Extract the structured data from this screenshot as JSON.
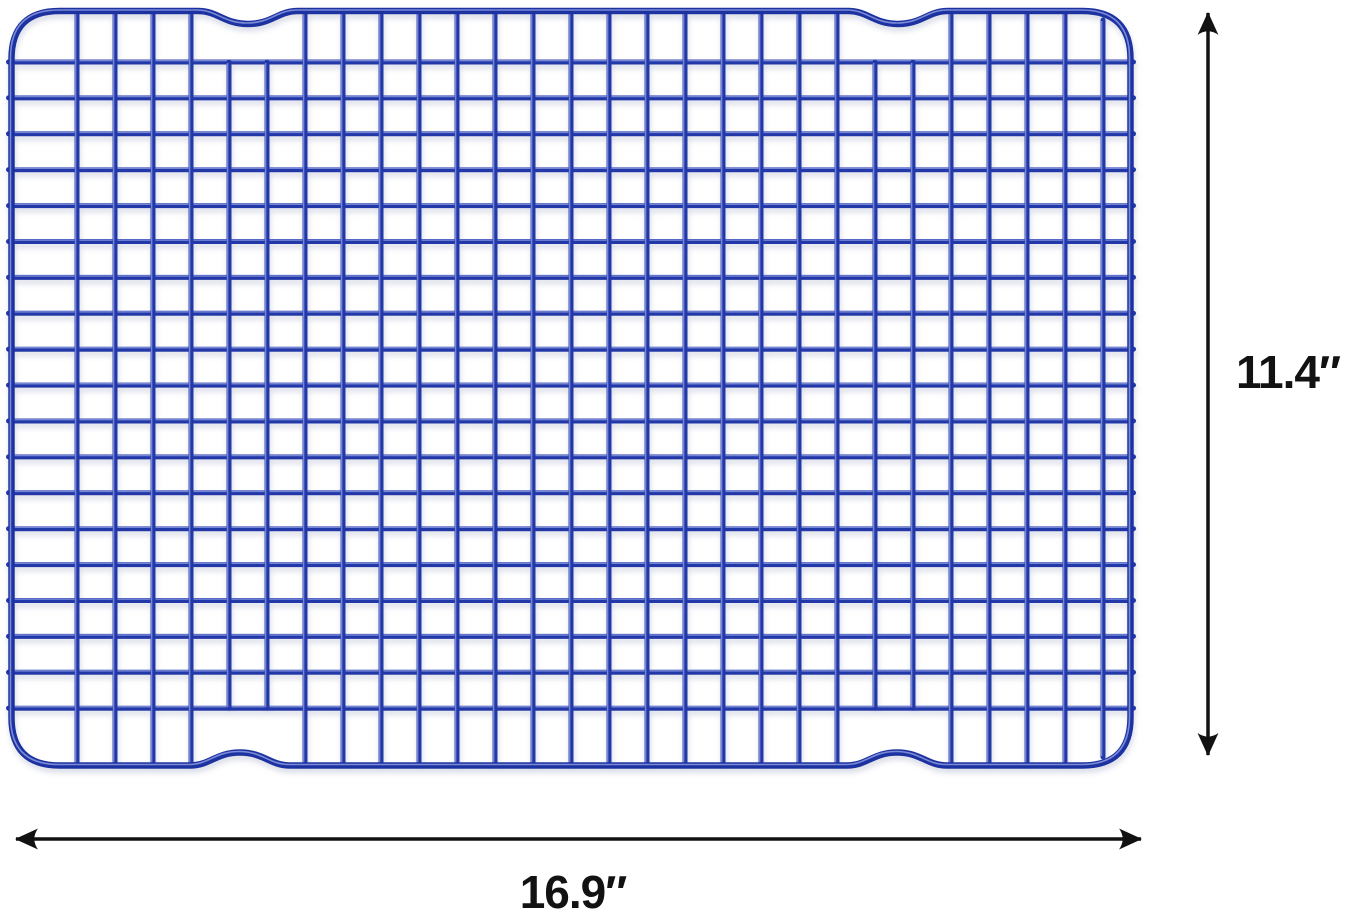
{
  "meta": {
    "type": "product-dimension-illustration",
    "subject": "Blue coated wire grid cooling rack (baking rack) viewed from above, annotated with measurement arrows",
    "background_color": "#ffffff"
  },
  "rack": {
    "label": "blue-wire-cooling-rack",
    "wire_color": "#2339a8",
    "wire_highlight_color": "#8494de",
    "frame_color": "#1f33a0",
    "shadow_color": "#9099b8",
    "cross_wires": 28,
    "long_wires": 19,
    "frame_style": "rounded rectangle with two shallow handle notches on top edge and two on bottom edge"
  },
  "dimensions": {
    "arrow_color": "#121212",
    "height": {
      "label": "11.4″",
      "side": "right"
    },
    "width": {
      "label": "16.9″",
      "side": "bottom"
    }
  }
}
